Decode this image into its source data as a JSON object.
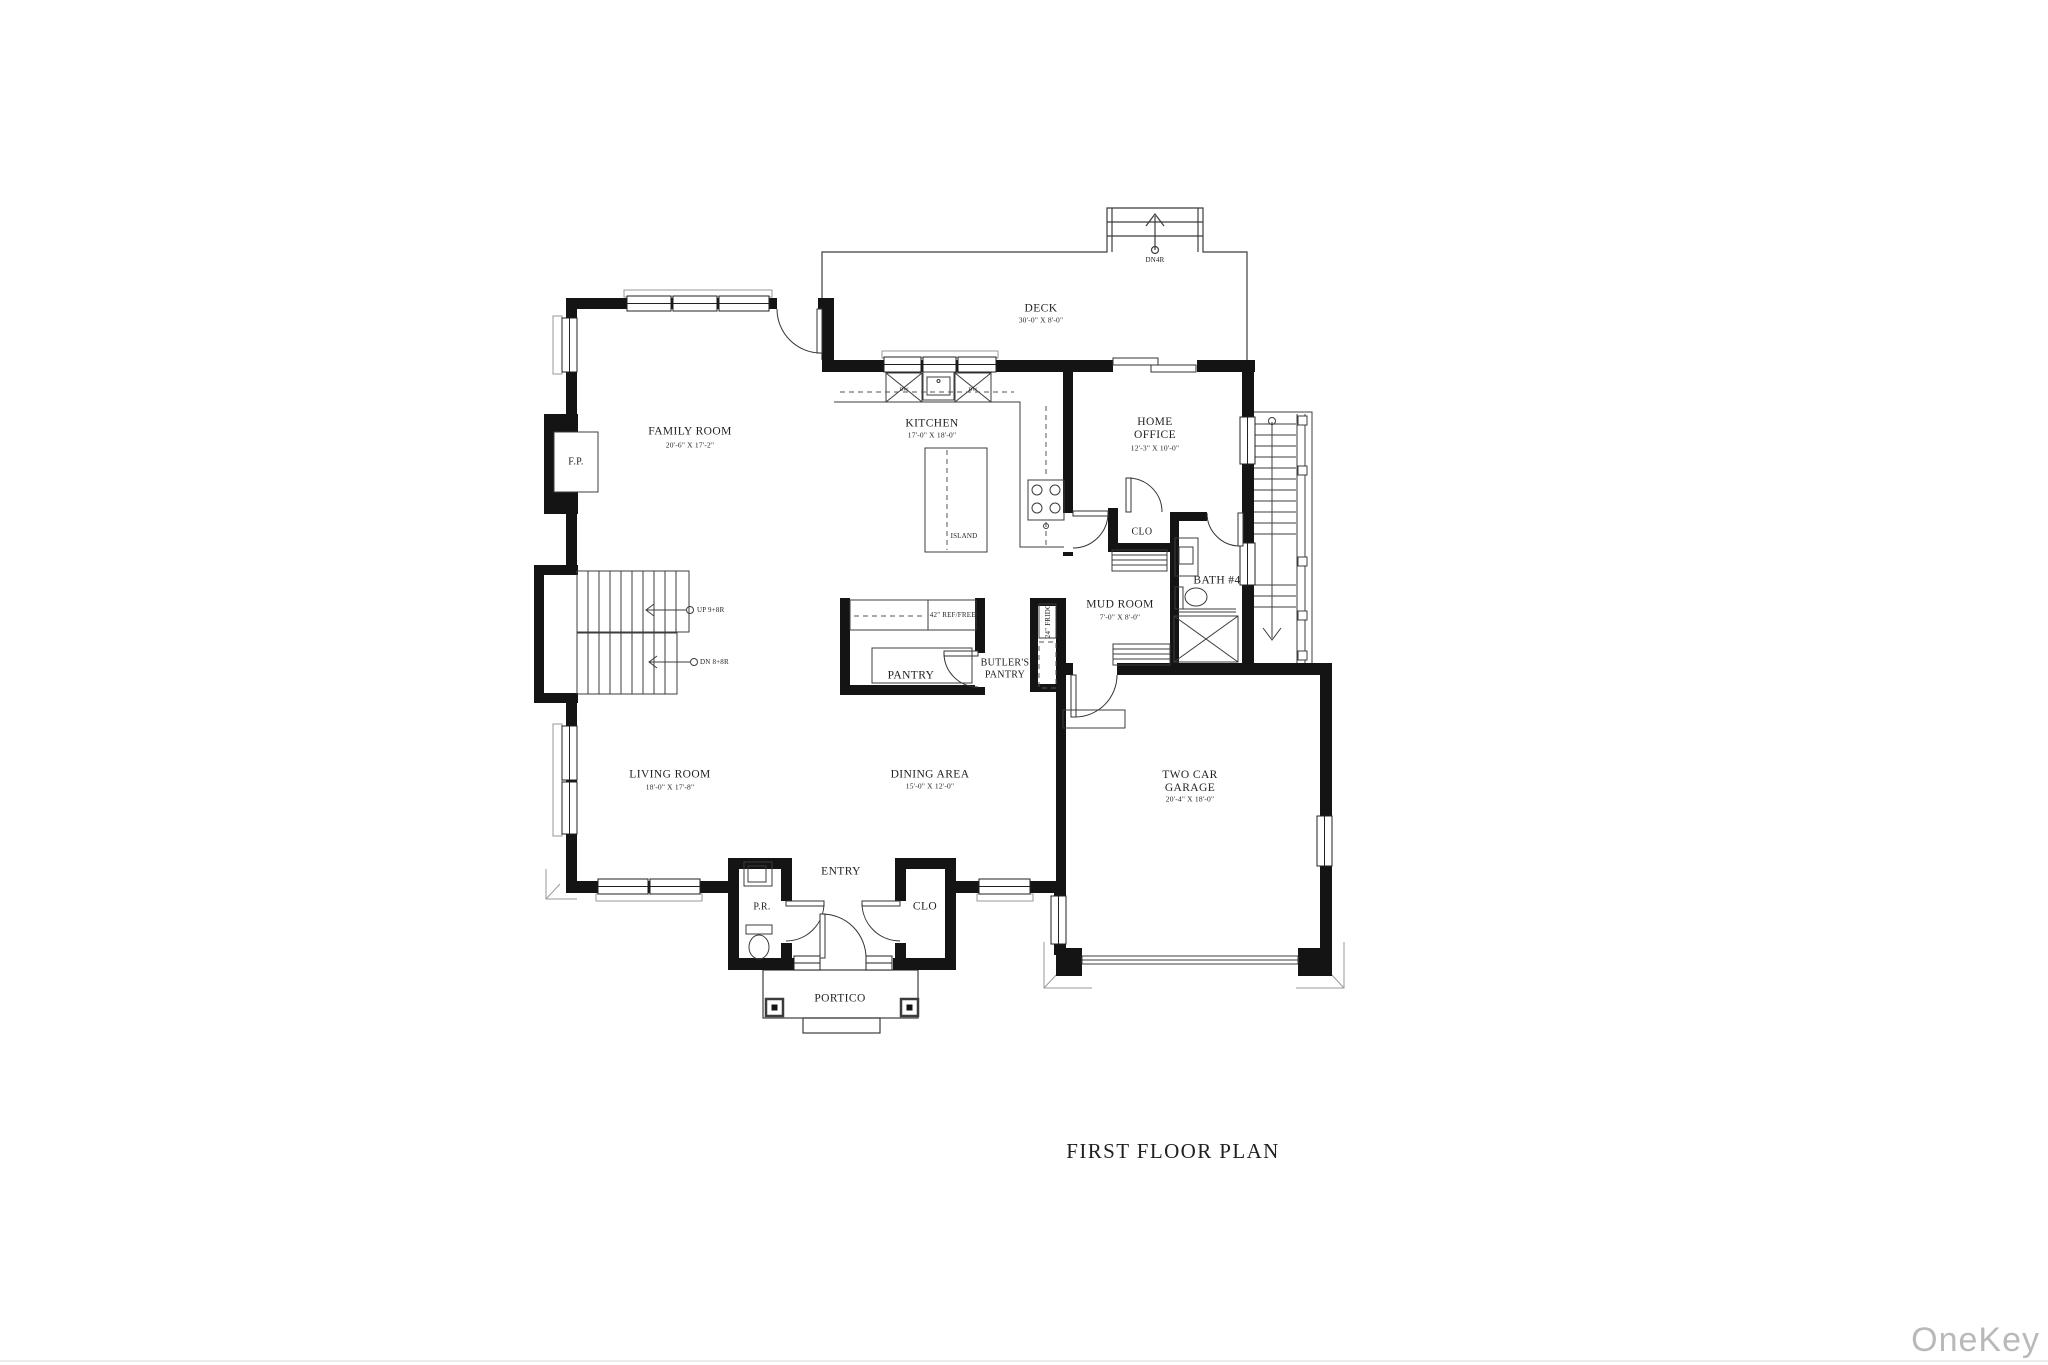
{
  "title": "FIRST FLOOR PLAN",
  "watermark": "OneKey MLS",
  "rooms": {
    "deck": {
      "name": "DECK",
      "dims": "30'-0\" X 8'-0\""
    },
    "family_room": {
      "name": "FAMILY ROOM",
      "dims": "20'-6\" X 17'-2\""
    },
    "kitchen": {
      "name": "KITCHEN",
      "dims": "17'-0\" X 18'-0\""
    },
    "home_office": {
      "name": "HOME OFFICE",
      "dims": "12'-3\" X 10'-0\""
    },
    "mud_room": {
      "name": "MUD ROOM",
      "dims": "7'-0\" X 8'-0\""
    },
    "bath4": {
      "name": "BATH #4"
    },
    "clo_hall": {
      "name": "CLO"
    },
    "pantry": {
      "name": "PANTRY"
    },
    "butlers_pantry": {
      "name": "BUTLER'S PANTRY"
    },
    "living_room": {
      "name": "LIVING ROOM",
      "dims": "18'-0\" X 17'-8\""
    },
    "dining_area": {
      "name": "DINING AREA",
      "dims": "15'-0\" X 12'-0\""
    },
    "entry": {
      "name": "ENTRY"
    },
    "powder_room": {
      "name": "P.R."
    },
    "clo_entry": {
      "name": "CLO"
    },
    "garage": {
      "name": "TWO CAR GARAGE",
      "dims": "20'-4\" X 18'-0\""
    },
    "portico": {
      "name": "PORTICO"
    }
  },
  "fixtures": {
    "island": "ISLAND",
    "ref_freez": "42\" REF/FREEZ",
    "fridge": "24\" FRIDG",
    "fireplace": "F.P.",
    "dishwasher1": "DW",
    "dishwasher2": "DW"
  },
  "stairs": {
    "up": "UP 9+8R",
    "down": "DN 8+8R",
    "deck_down": "DN4R"
  },
  "colors": {
    "wall": "#141414",
    "line": "#3c3c3c",
    "watermark": "#b9b9b9"
  }
}
